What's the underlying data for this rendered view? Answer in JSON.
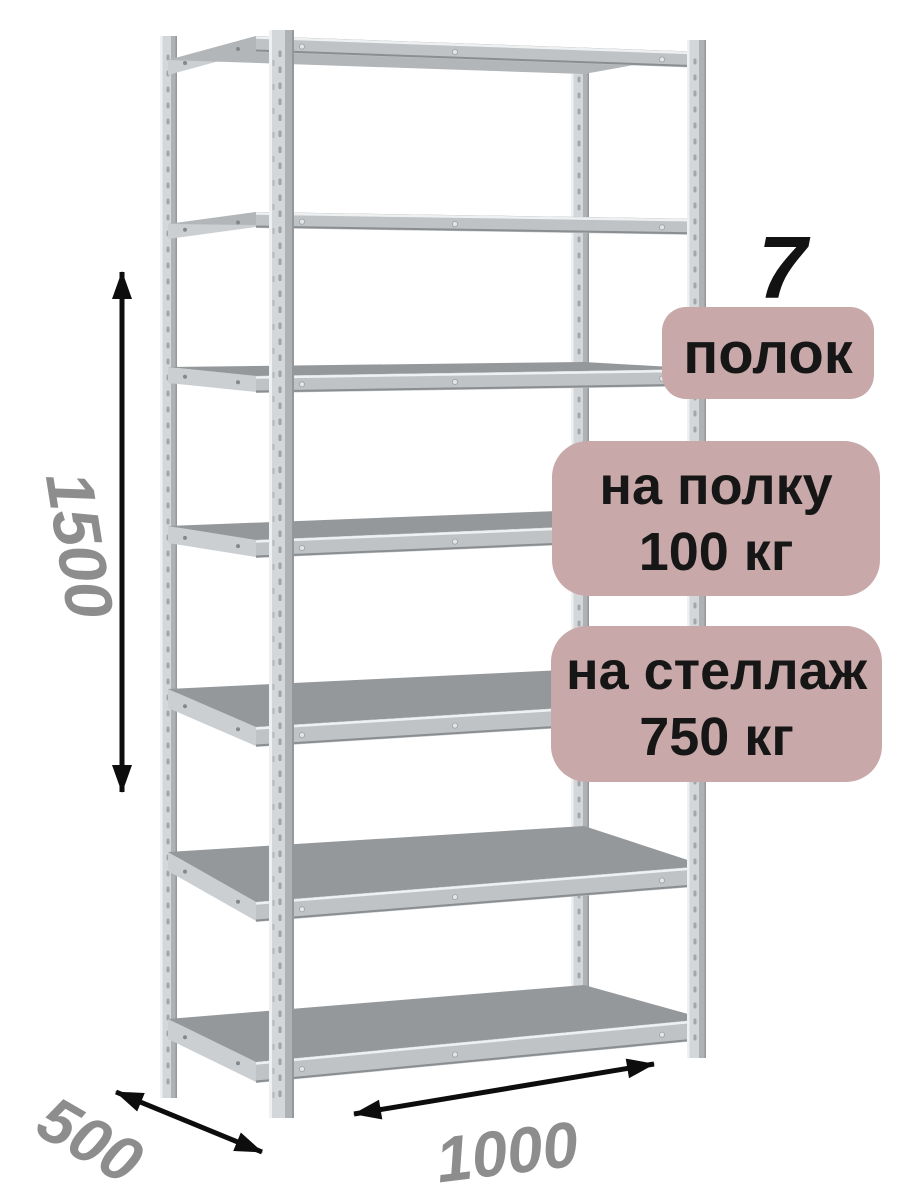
{
  "product": {
    "shelves_count": "7",
    "shelves_label": "полок",
    "per_shelf_load_line1": "на полку",
    "per_shelf_load_line2": "100 кг",
    "per_rack_load_line1": "на стеллаж",
    "per_rack_load_line2": "750 кг"
  },
  "dimensions": {
    "height_mm": "1500",
    "depth_mm": "500",
    "width_mm": "1000"
  },
  "colors": {
    "badge_bg": "#c8a8a8",
    "badge_text": "#161616",
    "dim_text": "#8d8d8d",
    "arrow": "#0d0d0d",
    "metal_face": "#d4d7d9",
    "metal_side": "#aeb2b5",
    "metal_highlight": "#eef0f1",
    "metal_edge_dark": "#94989b",
    "deck_top": "#94989b",
    "deck_underside": "#b2b6b9",
    "edge_face": "#bfc3c6",
    "edge_shadow": "#8a8e91",
    "stringer": "#cbcfd2"
  }
}
